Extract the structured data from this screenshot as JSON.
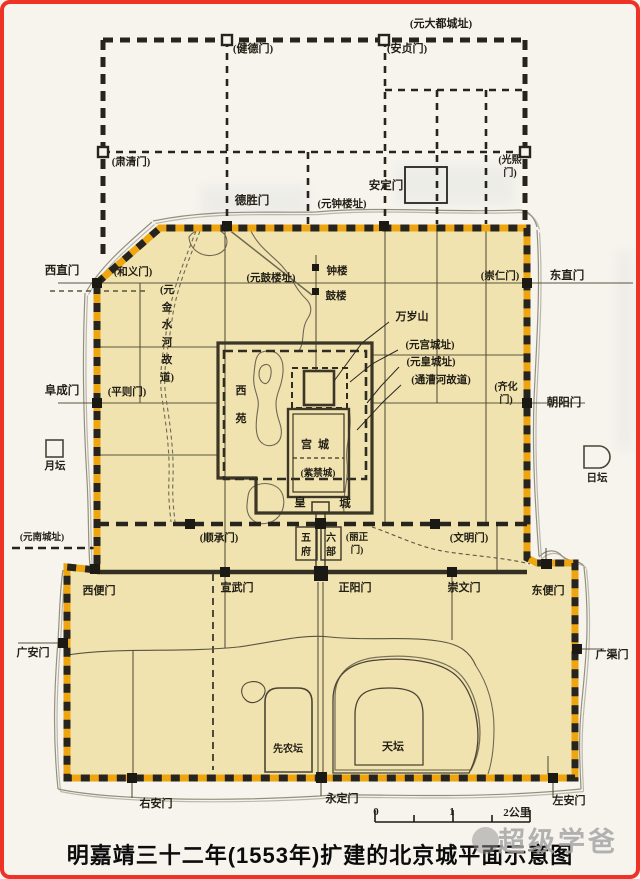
{
  "caption": {
    "text": "明嘉靖三十二年(1553年)扩建的北京城平面示意图"
  },
  "watermark": {
    "text": "超级学爸"
  },
  "map": {
    "colors": {
      "city_fill": "#f1e3b0",
      "wall_orange": "#efa50f",
      "wall_black": "#26241d",
      "frame_red": "#ee3326"
    },
    "labels": [
      {
        "id": "yuan-dadu-site",
        "t": "(元大都城址)",
        "x": 441,
        "y": 27,
        "s": 11
      },
      {
        "id": "jiandemen",
        "t": "(健德门)",
        "x": 253,
        "y": 52,
        "s": 11
      },
      {
        "id": "anzhenmen",
        "t": "(安贞门)",
        "x": 407,
        "y": 52,
        "s": 11
      },
      {
        "id": "suqingmen",
        "t": "(肃清门)",
        "x": 131,
        "y": 165,
        "s": 10.5
      },
      {
        "id": "guangximen",
        "lines": [
          "(光熙",
          "门)"
        ],
        "x": 510,
        "y": 163,
        "s": 10,
        "dy": 13
      },
      {
        "id": "andingmen",
        "t": "安定门",
        "x": 386,
        "y": 189,
        "s": 11.5
      },
      {
        "id": "deshengmen",
        "t": "德胜门",
        "x": 252,
        "y": 204,
        "s": 11.5
      },
      {
        "id": "yuan-zhonglou",
        "t": "(元钟楼址)",
        "x": 342,
        "y": 207,
        "s": 10.5
      },
      {
        "id": "zhonglou",
        "t": "钟楼",
        "x": 337,
        "y": 274,
        "s": 10.5
      },
      {
        "id": "gulou",
        "t": "鼓楼",
        "x": 336,
        "y": 299,
        "s": 10.5
      },
      {
        "id": "yuan-gulou",
        "t": "(元鼓楼址)",
        "x": 271,
        "y": 281,
        "s": 10.5
      },
      {
        "id": "heyimen",
        "t": "(和义门)",
        "x": 133,
        "y": 275,
        "s": 10.5
      },
      {
        "id": "xizhimen",
        "t": "西直门",
        "x": 62,
        "y": 274,
        "s": 11.5
      },
      {
        "id": "chongrenmen",
        "t": "(崇仁门)",
        "x": 500,
        "y": 279,
        "s": 10.5
      },
      {
        "id": "dongzhimen",
        "t": "东直门",
        "x": 567,
        "y": 279,
        "s": 11.5
      },
      {
        "id": "jinshuihe",
        "lines": [
          "(元",
          "金",
          "水",
          "河",
          "故",
          "道)"
        ],
        "x": 167,
        "y": 293,
        "s": 10.5,
        "dy": 17.5
      },
      {
        "id": "wansuishan",
        "t": "万岁山",
        "x": 412,
        "y": 320,
        "s": 11
      },
      {
        "id": "yuan-gongcheng-site",
        "t": "(元宫城址)",
        "x": 430,
        "y": 348,
        "s": 10.5
      },
      {
        "id": "yuan-huangcheng-site",
        "t": "(元皇城址)",
        "x": 431,
        "y": 365,
        "s": 10.5
      },
      {
        "id": "tonghuihe",
        "t": "(通漕河故道)",
        "x": 441,
        "y": 383,
        "s": 10.5
      },
      {
        "id": "qihuamen",
        "lines": [
          "(齐化",
          "门)"
        ],
        "x": 506,
        "y": 390,
        "s": 10,
        "dy": 13
      },
      {
        "id": "chaoyangmen",
        "t": "朝阳门",
        "x": 564,
        "y": 406,
        "s": 11.5
      },
      {
        "id": "pingzemen",
        "t": "(平则门)",
        "x": 127,
        "y": 395,
        "s": 10.5
      },
      {
        "id": "fuchengmen",
        "t": "阜成门",
        "x": 62,
        "y": 394,
        "s": 11.5
      },
      {
        "id": "xiyuan",
        "lines": [
          "西",
          "苑"
        ],
        "x": 241,
        "y": 394,
        "s": 11,
        "dy": 28
      },
      {
        "id": "gongcheng",
        "t": "宫城",
        "x": 318,
        "y": 448,
        "s": 11,
        "ls": 6
      },
      {
        "id": "zijincheng",
        "t": "(紫禁城)",
        "x": 318,
        "y": 476,
        "s": 9.5
      },
      {
        "id": "huang",
        "t": "皇",
        "x": 300,
        "y": 506,
        "s": 11.5
      },
      {
        "id": "cheng",
        "t": "城",
        "x": 345,
        "y": 507,
        "s": 11.5
      },
      {
        "id": "yuetan",
        "t": "月坛",
        "x": 55,
        "y": 469,
        "s": 10.5
      },
      {
        "id": "ritan",
        "t": "日坛",
        "x": 597,
        "y": 481,
        "s": 10.5
      },
      {
        "id": "shunchengmen",
        "t": "(顺承门)",
        "x": 219,
        "y": 541,
        "s": 10.5
      },
      {
        "id": "wufu",
        "lines": [
          "五",
          "府"
        ],
        "x": 306,
        "y": 541,
        "s": 10,
        "dy": 14
      },
      {
        "id": "liubu",
        "lines": [
          "六",
          "部"
        ],
        "x": 331,
        "y": 541,
        "s": 10,
        "dy": 14
      },
      {
        "id": "lizhengmen",
        "lines": [
          "(丽正",
          "门)"
        ],
        "x": 357,
        "y": 540,
        "s": 9.5,
        "dy": 13
      },
      {
        "id": "wenmingmen",
        "t": "(文明门)",
        "x": 469,
        "y": 541,
        "s": 10.5
      },
      {
        "id": "yuan-nancheng-site",
        "t": "(元南城址)",
        "x": 42,
        "y": 540,
        "s": 9.5
      },
      {
        "id": "xibianmen",
        "t": "西便门",
        "x": 99,
        "y": 594,
        "s": 11
      },
      {
        "id": "xuanwumen",
        "t": "宣武门",
        "x": 237,
        "y": 591,
        "s": 11
      },
      {
        "id": "zhengyangmen",
        "t": "正阳门",
        "x": 355,
        "y": 591,
        "s": 11
      },
      {
        "id": "chongwenmen",
        "t": "崇文门",
        "x": 464,
        "y": 591,
        "s": 11
      },
      {
        "id": "dongbianmen",
        "t": "东便门",
        "x": 548,
        "y": 594,
        "s": 11
      },
      {
        "id": "guanganmen",
        "t": "广安门",
        "x": 33,
        "y": 656,
        "s": 11
      },
      {
        "id": "guangqumen",
        "t": "广渠门",
        "x": 612,
        "y": 658,
        "s": 11
      },
      {
        "id": "xiannongtan",
        "t": "先农坛",
        "x": 288,
        "y": 752,
        "s": 10
      },
      {
        "id": "tiantan",
        "t": "天坛",
        "x": 393,
        "y": 750,
        "s": 11
      },
      {
        "id": "youanmen",
        "t": "右安门",
        "x": 156,
        "y": 807,
        "s": 11
      },
      {
        "id": "yongdingmen",
        "t": "永定门",
        "x": 342,
        "y": 802,
        "s": 11
      },
      {
        "id": "zuoanmen",
        "t": "左安门",
        "x": 569,
        "y": 804,
        "s": 11
      },
      {
        "id": "scale-0",
        "t": "0",
        "x": 376,
        "y": 815,
        "s": 11
      },
      {
        "id": "scale-1",
        "t": "1",
        "x": 452,
        "y": 815,
        "s": 11
      },
      {
        "id": "scale-2km",
        "t": "2公里",
        "x": 517,
        "y": 816,
        "s": 11
      }
    ]
  }
}
